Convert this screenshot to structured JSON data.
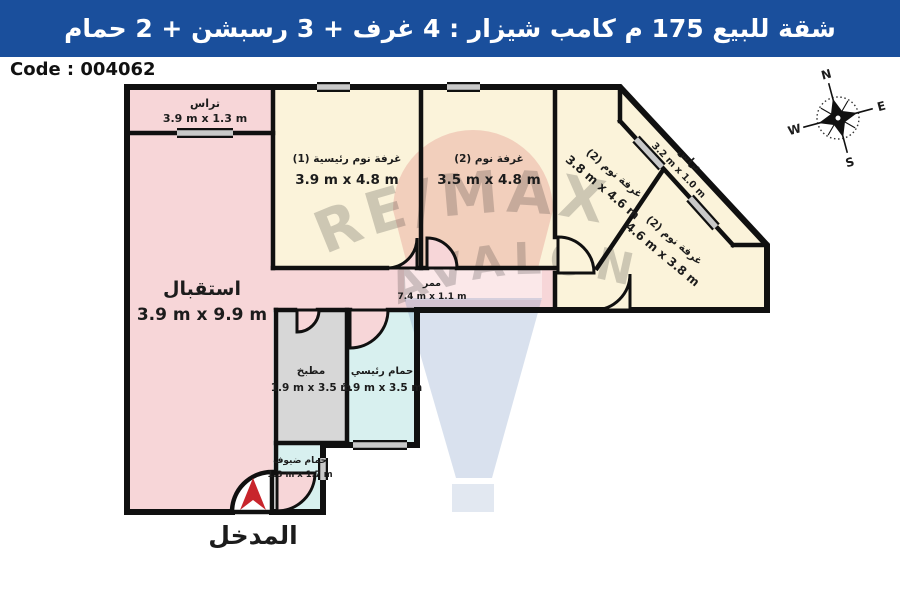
{
  "banner": {
    "title": "شقة للبيع 175 م كامب شيزار :  4 غرف + 3 رسبشن + 2 حمام",
    "bg_color": "#1a4f9c",
    "text_color": "#ffffff"
  },
  "code_label": "Code : 004062",
  "entrance": {
    "label": "المدخل",
    "arrow_color": "#c8252c"
  },
  "compass": {
    "n": "N",
    "e": "E",
    "s": "S",
    "w": "W"
  },
  "watermark": {
    "line1": "RE/MAX",
    "line2": "AVALON"
  },
  "rooms": {
    "terrace_top": {
      "name": "تراس",
      "dims": "3.9 m x 1.3 m"
    },
    "reception": {
      "name": "استقبال",
      "dims": "3.9 m x 9.9 m"
    },
    "master_bedroom": {
      "name": "غرفة نوم رئيسية (1)",
      "dims": "3.9 m x 4.8 m"
    },
    "bedroom_2": {
      "name": "غرفة نوم (2)",
      "dims": "3.5 m x 4.8 m"
    },
    "bedroom_3": {
      "name": "غرفة نوم (2)",
      "dims": "3.8 m x 4.6 m"
    },
    "bedroom_4": {
      "name": "غرفة نوم (2)",
      "dims": "4.6 m x 3.8 m"
    },
    "terrace_side": {
      "name": "تراس",
      "dims": "3.2 m x 1.0 m"
    },
    "corridor": {
      "name": "ممر",
      "dims": "7.4 m x 1.1 m"
    },
    "kitchen": {
      "name": "مطبخ",
      "dims": "1.9 m x 3.5 m"
    },
    "master_bathroom": {
      "name": "حمام رئيسي",
      "dims": "1.9 m x 3.5 m"
    },
    "guest_bathroom": {
      "name": "حمام ضيوف",
      "dims": "1.3 m x 1.7 m"
    }
  },
  "colors": {
    "pink": "#f7d6d8",
    "cream": "#fbf3da",
    "gray": "#d7d7d7",
    "cyan": "#d8f0ef",
    "wall": "#101010",
    "window_gray": "#c9c9c9",
    "arrow_red": "#c8252c"
  }
}
